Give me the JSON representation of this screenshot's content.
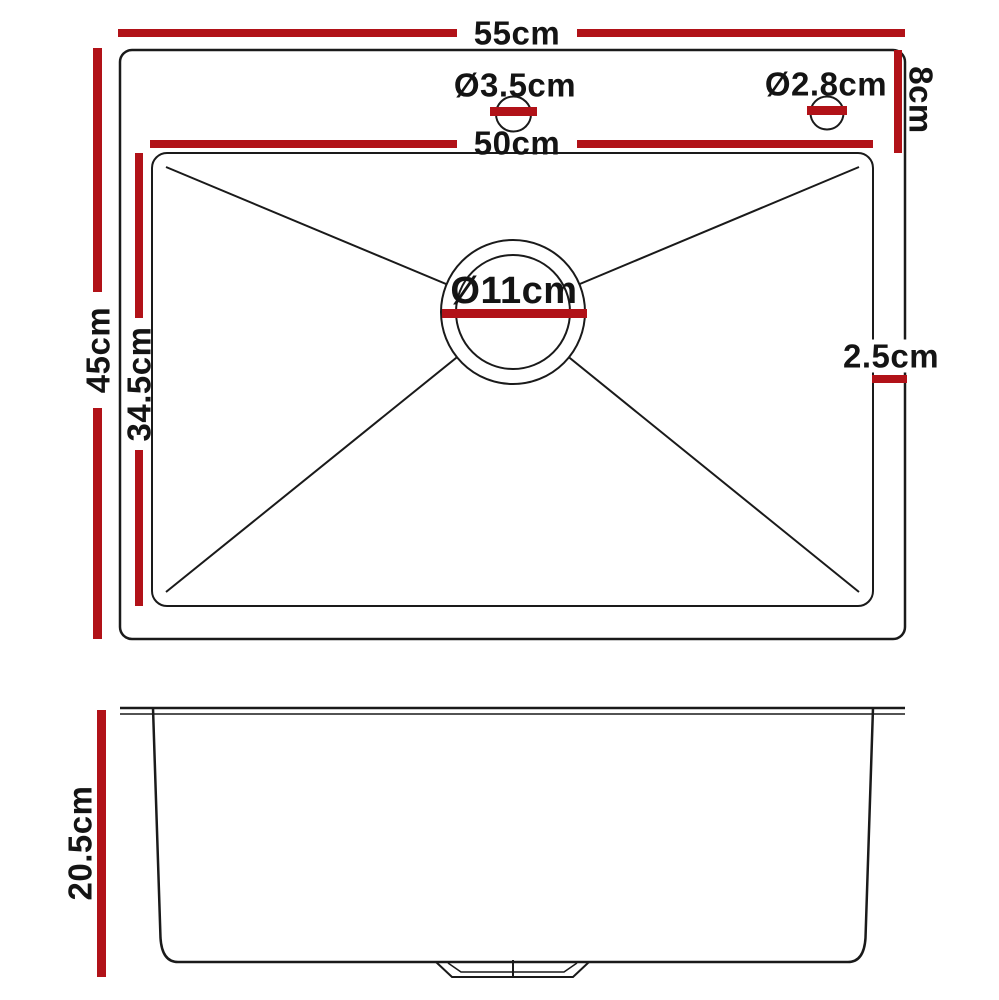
{
  "diagram": {
    "subject": "kitchen sink dimension drawing",
    "views": {
      "top_view": "top view with bowl, faucet holes and drain",
      "side_view": "front profile view of bowl depth"
    }
  },
  "labels": {
    "overall_width": "55cm",
    "bowl_width": "50cm",
    "overall_depth": "45cm",
    "bowl_depth": "34.5cm",
    "hole_offset": "8cm",
    "faucet_hole_diameter": "Ø3.5cm",
    "accessory_hole_diameter": "Ø2.8cm",
    "drain_diameter": "Ø11cm",
    "edge_gap": "2.5cm",
    "bowl_height": "20.5cm"
  },
  "colors": {
    "dimension_red": "#b11218",
    "line_black": "#1a1a1a"
  }
}
